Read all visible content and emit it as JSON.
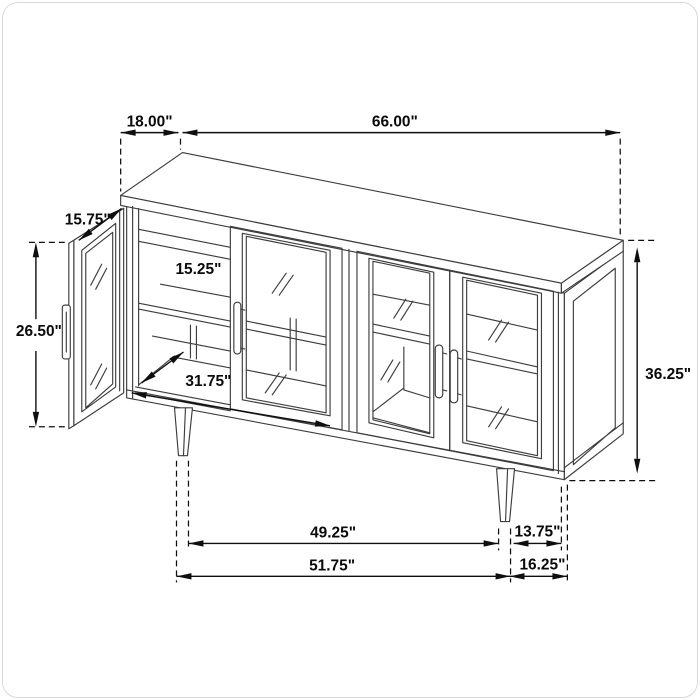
{
  "meta": {
    "title": "Sideboard cabinet dimension diagram",
    "units": "inches",
    "style": "isometric line drawing, black on white"
  },
  "canvas": {
    "background": "#ffffff",
    "border_color": "#d9d9d9",
    "line_color": "#3d3d3d",
    "dimension_color": "#0f0f0f"
  },
  "dimensions": {
    "top_depth": "18.00\"",
    "overall_width": "66.00\"",
    "door_width": "15.75\"",
    "door_height": "26.50\"",
    "shelf_depth": "15.25\"",
    "interior_width": "31.75\"",
    "overall_height": "36.25\"",
    "front_leg_span_inner": "49.25\"",
    "leg_to_back_depth": "13.75\"",
    "front_leg_span_outer": "51.75\"",
    "base_depth": "16.25\""
  }
}
